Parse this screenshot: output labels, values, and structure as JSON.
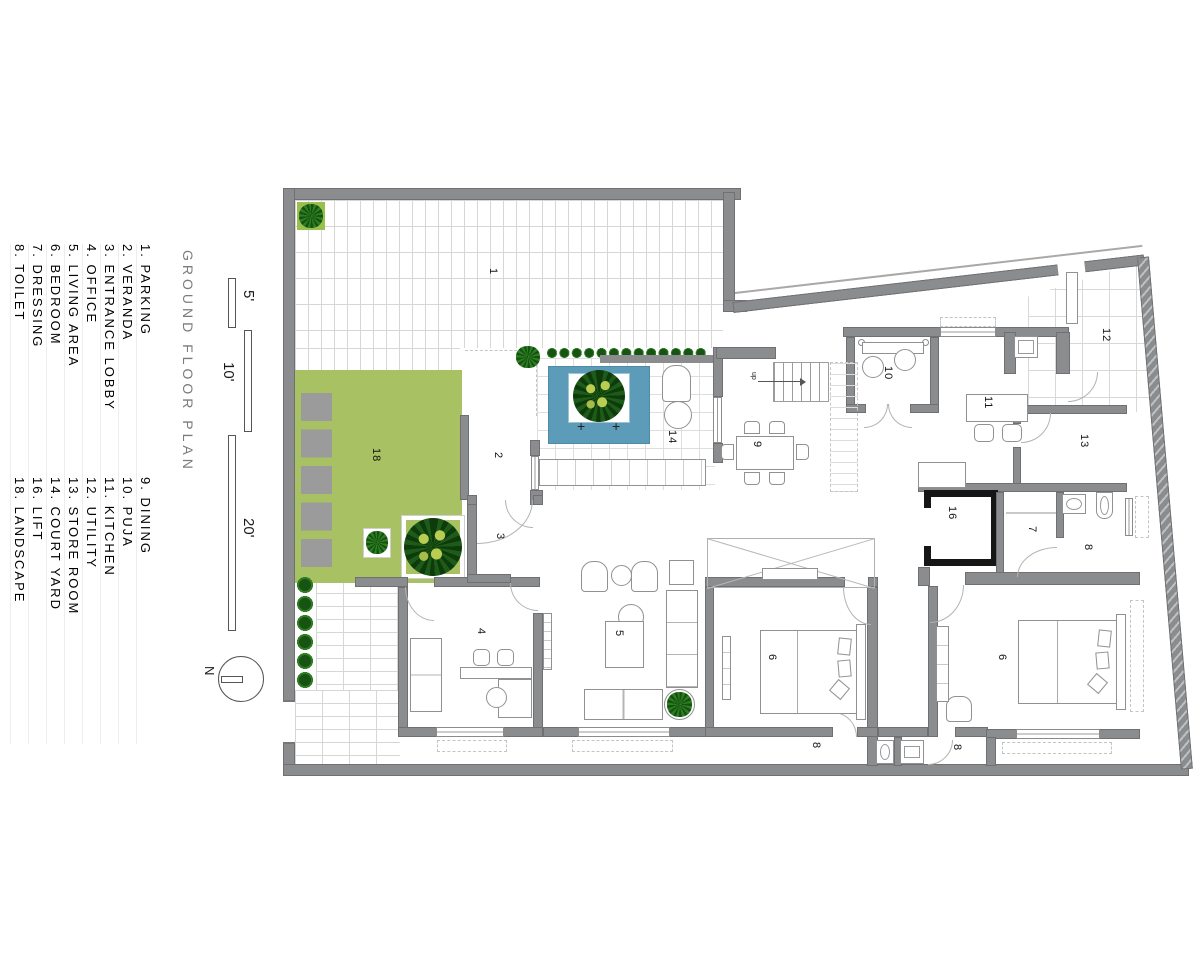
{
  "title": "GROUND FLOOR PLAN",
  "legend": {
    "columns": [
      {
        "top": "8. TOILET",
        "bottom": "18. LANDSCAPE"
      },
      {
        "top": "7. DRESSING",
        "bottom": "16. LIFT"
      },
      {
        "top": "6. BEDROOM",
        "bottom": "14. COURT YARD"
      },
      {
        "top": "5. LIVING AREA",
        "bottom": "13. STORE ROOM"
      },
      {
        "top": "4. OFFICE",
        "bottom": "12. UTILITY"
      },
      {
        "top": "3. ENTRANCE LOBBY",
        "bottom": "11. KITCHEN"
      },
      {
        "top": "2. VERANDA",
        "bottom": "10. PUJA"
      },
      {
        "top": "1. PARKING",
        "bottom": "9. DINING"
      }
    ]
  },
  "scale_bars": {
    "s5": "5'",
    "s10": "10'",
    "s20": "20'"
  },
  "north_label": "N",
  "plan": {
    "labels": {
      "r1": "1",
      "r2": "2",
      "r3": "3",
      "r4": "4",
      "r5": "5",
      "r6a": "6",
      "r6b": "6",
      "r7": "7",
      "r8a": "8",
      "r8b": "8",
      "r8c": "8",
      "r9": "9",
      "r10": "10",
      "r11": "11",
      "r12": "12",
      "r13": "13",
      "r14": "14",
      "r16": "16",
      "r18": "18",
      "up": "up",
      "plus": "+"
    }
  },
  "colors": {
    "wall": "#8a8c8e",
    "lift": "#161616",
    "green": "#a8c162",
    "pool": "#5c9cb8",
    "stone": "#9b9b9b",
    "plant": "#1e6b1e"
  }
}
